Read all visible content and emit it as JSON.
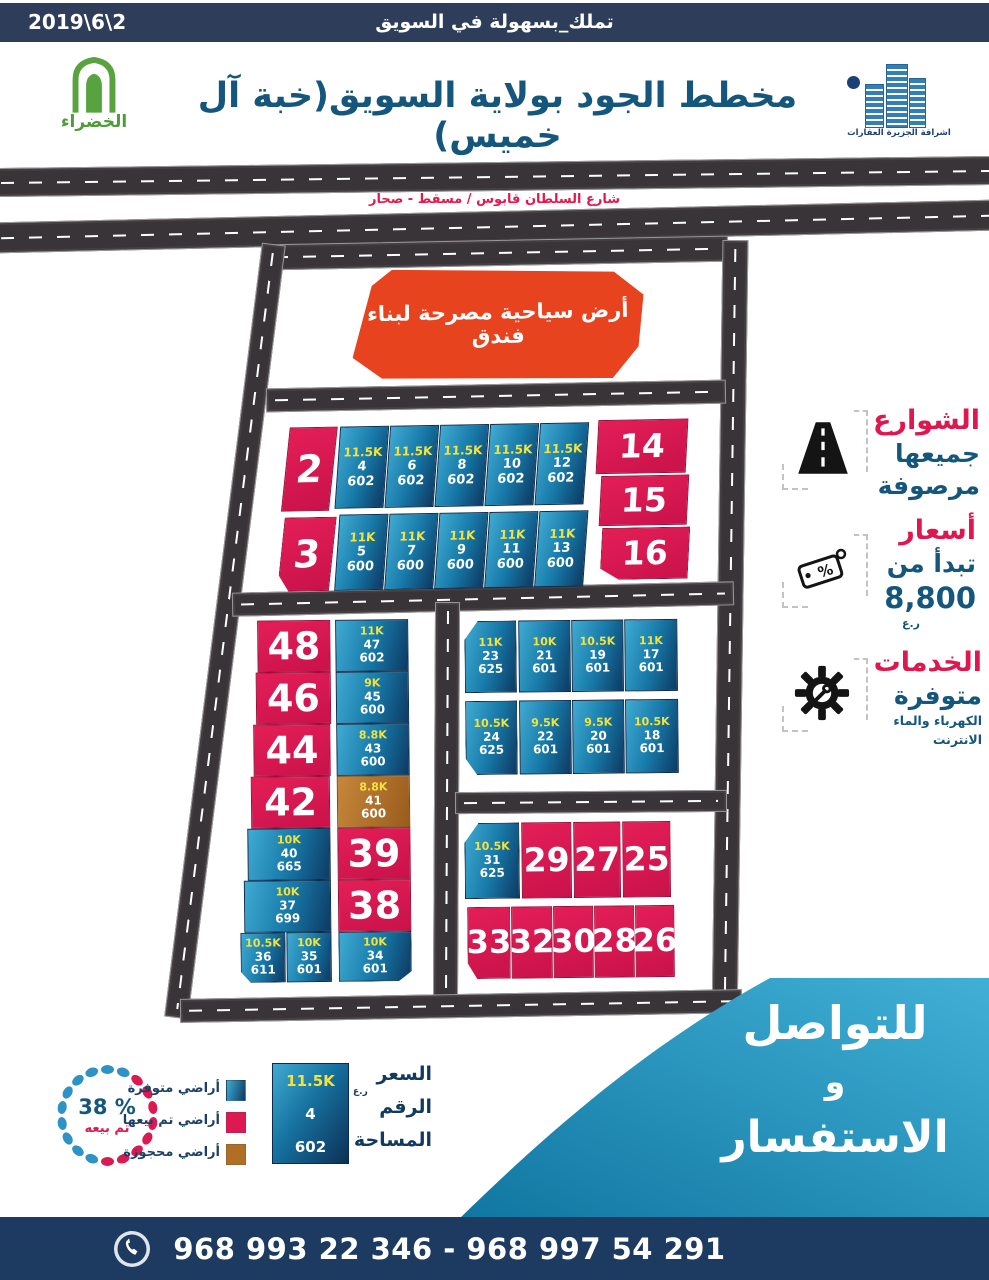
{
  "topbar": {
    "date": "2019\\6\\2",
    "slogan": "تملك_بسهولة  في السويق"
  },
  "header": {
    "title": "مخطط الجود بولاية السويق(خبة آل خميس)",
    "left_logo": "الخضراء",
    "right_logo": "اشراقة الجزيرة العقارات"
  },
  "highway": {
    "label": "شارع السلطان قابوس / مسقط - صحار"
  },
  "map": {
    "hotel": "أرض سياحية مصرحة لبناء فندق",
    "top": {
      "s2": "2",
      "s3": "3",
      "r": [
        "14",
        "15",
        "16"
      ],
      "row1": [
        {
          "price": "11.5K",
          "num": "4",
          "area": "602"
        },
        {
          "price": "11.5K",
          "num": "6",
          "area": "602"
        },
        {
          "price": "11.5K",
          "num": "8",
          "area": "602"
        },
        {
          "price": "11.5K",
          "num": "10",
          "area": "602"
        },
        {
          "price": "11.5K",
          "num": "12",
          "area": "602"
        }
      ],
      "row2": [
        {
          "price": "11K",
          "num": "5",
          "area": "600"
        },
        {
          "price": "11K",
          "num": "7",
          "area": "600"
        },
        {
          "price": "11K",
          "num": "9",
          "area": "600"
        },
        {
          "price": "11K",
          "num": "11",
          "area": "600"
        },
        {
          "price": "11K",
          "num": "13",
          "area": "600"
        }
      ]
    },
    "left": {
      "sold": [
        "48",
        "46",
        "44",
        "42"
      ],
      "a": [
        {
          "price": "10K",
          "num": "40",
          "area": "665"
        },
        {
          "price": "10K",
          "num": "37",
          "area": "699"
        },
        {
          "price": "10.5K",
          "num": "36",
          "area": "611"
        },
        {
          "price": "10K",
          "num": "35",
          "area": "601"
        }
      ],
      "b": [
        {
          "price": "11K",
          "num": "47",
          "area": "602"
        },
        {
          "price": "9K",
          "num": "45",
          "area": "600"
        },
        {
          "price": "8.8K",
          "num": "43",
          "area": "600"
        }
      ],
      "reserved": {
        "price": "8.8K",
        "num": "41",
        "area": "600"
      },
      "sold2": [
        "39",
        "38"
      ],
      "b34": {
        "price": "10K",
        "num": "34",
        "area": "601"
      }
    },
    "rt": {
      "row1": [
        {
          "price": "11K",
          "num": "23",
          "area": "625"
        },
        {
          "price": "10K",
          "num": "21",
          "area": "601"
        },
        {
          "price": "10.5K",
          "num": "19",
          "area": "601"
        },
        {
          "price": "11K",
          "num": "17",
          "area": "601"
        }
      ],
      "row2": [
        {
          "price": "10.5K",
          "num": "24",
          "area": "625"
        },
        {
          "price": "9.5K",
          "num": "22",
          "area": "601"
        },
        {
          "price": "9.5K",
          "num": "20",
          "area": "601"
        },
        {
          "price": "10.5K",
          "num": "18",
          "area": "601"
        }
      ]
    },
    "rb": {
      "a31": {
        "price": "10.5K",
        "num": "31",
        "area": "625"
      },
      "row1": [
        "29",
        "27",
        "25"
      ],
      "row2": [
        "33",
        "32",
        "30",
        "28",
        "26"
      ]
    }
  },
  "legend_right": {
    "streets": {
      "title": "الشوارع",
      "line1": "جميعها",
      "line2": "مرصوفة"
    },
    "prices": {
      "title": "أسعار",
      "line1": "تبدأ من",
      "line2": "8,800",
      "unit": "ر.ع"
    },
    "services": {
      "title": "الخدمات",
      "line1": "متوفرة",
      "line2": "الكهرباء والماء",
      "line3": "الانترنت"
    }
  },
  "legend_left": {
    "pct": "38 %",
    "pct_label": "تم بيعه",
    "available": "أراضي متوفرة",
    "sold": "أراضي تم بيعها",
    "reserved": "أراضي محجوزة",
    "sample": {
      "price": "11.5K",
      "num": "4",
      "area": "602",
      "price_label": "السعر",
      "unit": "ر.ع",
      "num_label": "الرقم",
      "area_label": "المساحة"
    }
  },
  "contact": {
    "line1": "للتواصل",
    "line2": "و",
    "line3": "الاستفسار",
    "phones": "968 993 22 346 - 968 997 54 291"
  },
  "colors": {
    "sold": "#dc1950",
    "available_light": "#3fabd2",
    "available_dark": "#0d3a63",
    "reserved": "#b06f26",
    "accent_red": "#e0164f",
    "accent_blue": "#15567d",
    "bar_navy": "#2e3e5a",
    "bottom_navy": "#1d3a60",
    "teal": "#2e9dc3"
  }
}
